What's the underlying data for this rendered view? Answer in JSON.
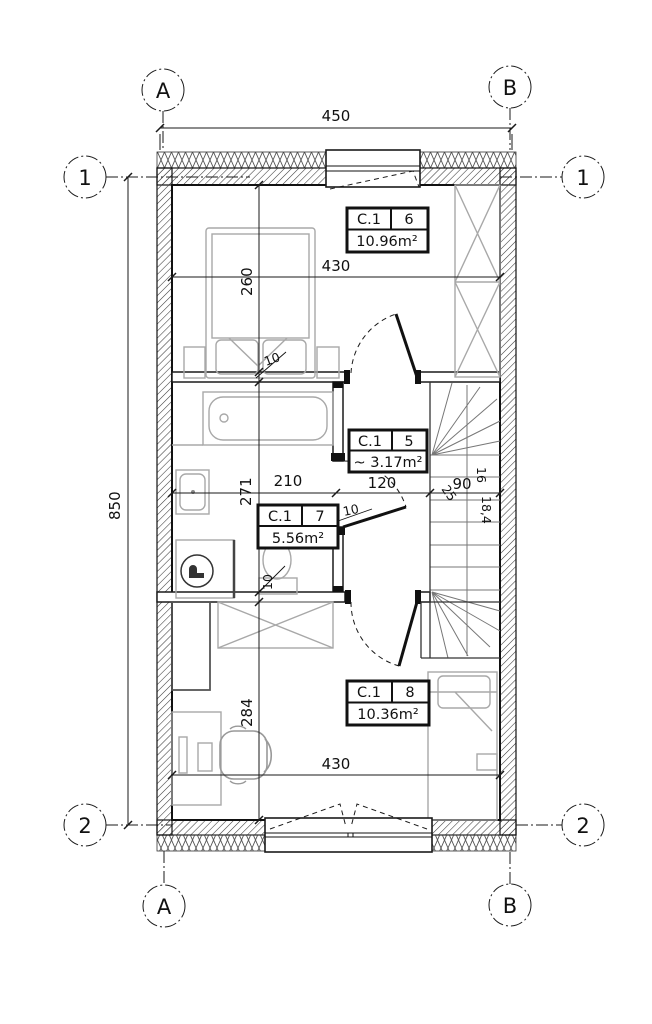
{
  "axes": {
    "a": "A",
    "b": "B",
    "one": "1",
    "two": "2"
  },
  "dims": {
    "width_total": "450",
    "height_total": "850",
    "room6_w": "430",
    "room6_h": "260",
    "bath_w": "210",
    "bath_h": "271",
    "hall_w": "120",
    "stair_w": "90",
    "room8_w": "430",
    "room8_h": "284",
    "wall_thk_a": "10",
    "wall_thk_b": "10",
    "wall_thk_c": "10",
    "stair_count": "16",
    "stair_rise": "18,4",
    "stair_tread": "25"
  },
  "rooms": [
    {
      "unit": "C.1",
      "no": "6",
      "area": "10.96m²"
    },
    {
      "unit": "C.1",
      "no": "5",
      "area": "~ 3.17m²"
    },
    {
      "unit": "C.1",
      "no": "7",
      "area": "5.56m²"
    },
    {
      "unit": "C.1",
      "no": "8",
      "area": "10.36m²"
    }
  ]
}
